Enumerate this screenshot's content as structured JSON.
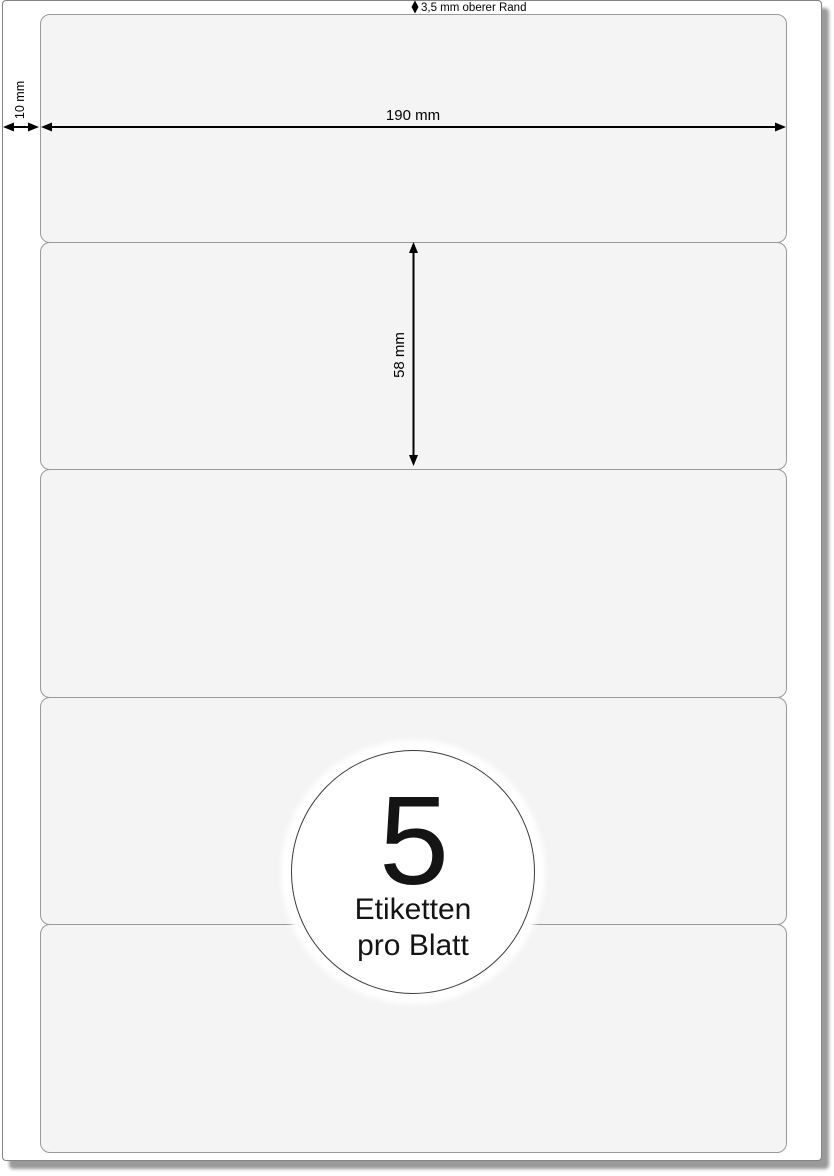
{
  "diagram": {
    "sheet": {
      "label_slots": 5,
      "top_margin_label": "3,5 mm oberer Rand",
      "left_margin_label": "10 mm",
      "label_width_label": "190 mm",
      "label_height_label": "58 mm"
    },
    "badge": {
      "count": "5",
      "line1": "Etiketten",
      "line2": "pro Blatt"
    },
    "colors": {
      "label_fill": "#f4f4f5",
      "label_border": "#999999",
      "page_border": "#848484",
      "page_shadow": "#9a9a9a",
      "annotation": "#000000",
      "badge_border": "#3c3c3c"
    }
  }
}
